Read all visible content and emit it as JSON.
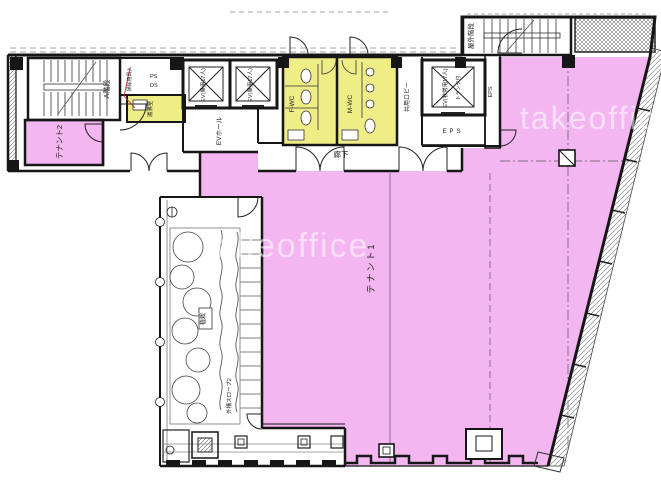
{
  "plan": {
    "watermark": "takeoffice",
    "colors": {
      "tenant_fill": "#f4b6f0",
      "wet_area_fill": "#efed85",
      "wall": "#161616",
      "leader_red": "#cc3333"
    },
    "labels": {
      "tenant1": "テナント1",
      "tenant2": "テナント2",
      "stair_a": "A階段",
      "outdoor_stair": "屋外階段",
      "ev_hall": "EVホール",
      "ev_passenger_1": "EV(乗用17人)",
      "ev_passenger_2": "EV(乗用17人)",
      "ev_emergency": "EV(非常用17人)",
      "ev_emergency_note": "トランク付",
      "corridor": "廊下",
      "shared_lobby": "共用ロビー",
      "wc_female": "F-WC",
      "wc_male": "M-WC",
      "kitchenette": "湯沸室",
      "cleaning_closet": "掃除用具入",
      "ps": "PS",
      "ds": "DS",
      "eps_room": "EPS",
      "eps_shaft": "EPS",
      "planting": "植栽",
      "exterior_slope": "外構スロープ2"
    }
  }
}
